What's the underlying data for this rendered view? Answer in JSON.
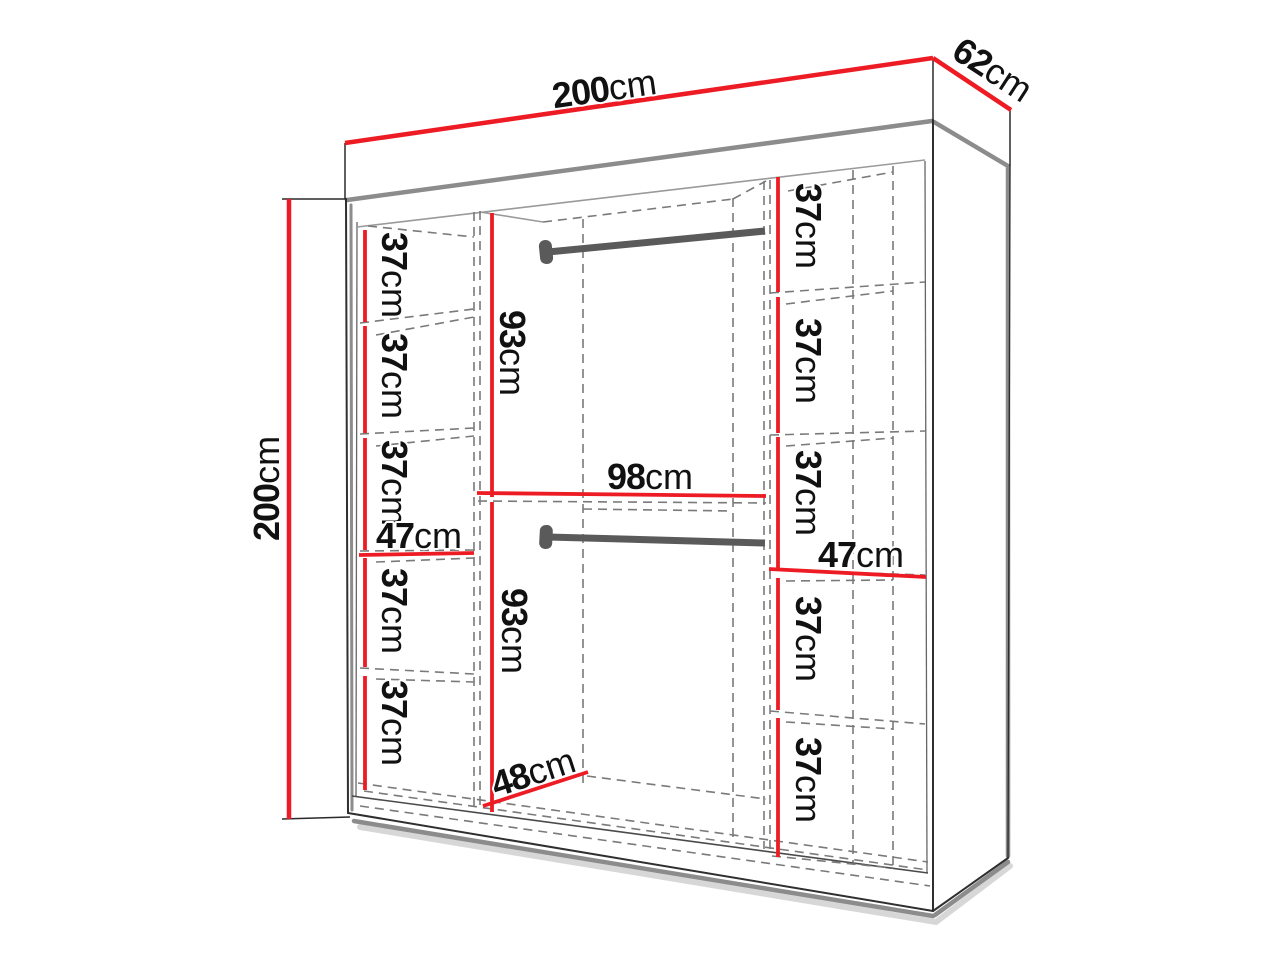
{
  "labels": {
    "width_top": {
      "value": "200",
      "unit": "cm"
    },
    "depth_top": {
      "value": "62",
      "unit": "cm"
    },
    "height_left": {
      "value": "200",
      "unit": "cm"
    },
    "left_column": {
      "shelves": [
        {
          "value": "37",
          "unit": "cm"
        },
        {
          "value": "37",
          "unit": "cm"
        },
        {
          "value": "37",
          "unit": "cm"
        },
        {
          "value": "37",
          "unit": "cm"
        },
        {
          "value": "37",
          "unit": "cm"
        }
      ],
      "width": {
        "value": "47",
        "unit": "cm"
      }
    },
    "middle_column": {
      "upper_section": {
        "value": "93",
        "unit": "cm"
      },
      "width": {
        "value": "98",
        "unit": "cm"
      },
      "lower_section": {
        "value": "93",
        "unit": "cm"
      },
      "floor_depth": {
        "value": "48",
        "unit": "cm"
      }
    },
    "right_column": {
      "shelves": [
        {
          "value": "37",
          "unit": "cm"
        },
        {
          "value": "37",
          "unit": "cm"
        },
        {
          "value": "37",
          "unit": "cm"
        },
        {
          "value": "37",
          "unit": "cm"
        },
        {
          "value": "37",
          "unit": "cm"
        }
      ],
      "width": {
        "value": "47",
        "unit": "cm"
      }
    }
  },
  "colors": {
    "dimension_red": "#ed1c24",
    "rod_gray": "#5a5a5a",
    "shadow_gray": "#8c8c8c",
    "dash_gray": "#7a7a7a",
    "outline": "#2f2f2f",
    "text": "#111111",
    "background": "#ffffff"
  }
}
